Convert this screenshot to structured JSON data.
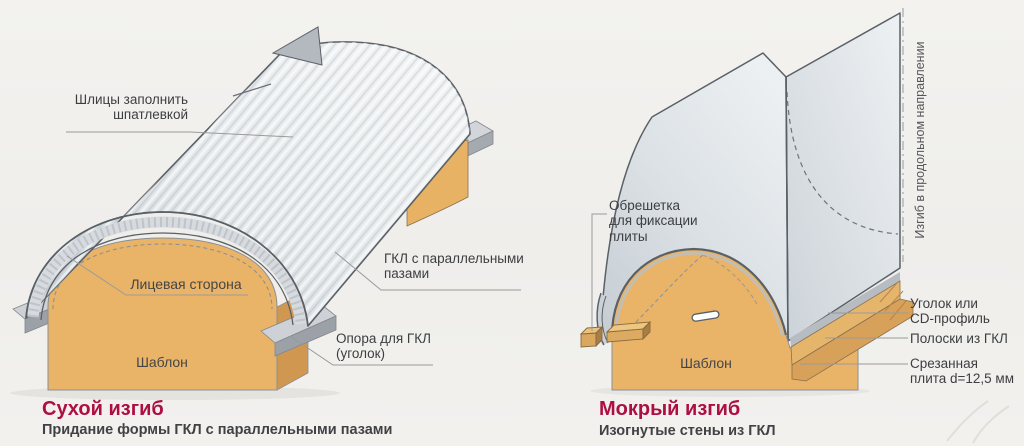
{
  "colors": {
    "background": "#f1f0ed",
    "accent_title": "#ad0e44",
    "label_text": "#3d3e41",
    "subtitle_text": "#414246",
    "wood": "#e9b468",
    "sheet": "#dfe3e7"
  },
  "left_panel": {
    "title": "Сухой изгиб",
    "subtitle": "Придание формы ГКЛ с параллельными пазами",
    "labels": {
      "slits": [
        "Шлицы заполнить",
        "шпатлевкой"
      ],
      "face_side": "Лицевая сторона",
      "template": "Шаблон",
      "gkl": [
        "ГКЛ с параллельными",
        "пазами"
      ],
      "support": [
        "Опора для ГКЛ",
        "(уголок)"
      ]
    }
  },
  "right_panel": {
    "title": "Мокрый изгиб",
    "subtitle": "Изогнутые стены из ГКЛ",
    "labels": {
      "lathing": [
        "Обрешетка",
        "для фиксации",
        "плиты"
      ],
      "template": "Шаблон",
      "longitudinal": "Изгиб в продольном направлении",
      "corner": [
        "Уголок или",
        "CD-профиль"
      ],
      "strips": "Полоски из ГКЛ",
      "cut_plate": [
        "Срезанная",
        "плита d=12,5 мм"
      ]
    }
  }
}
